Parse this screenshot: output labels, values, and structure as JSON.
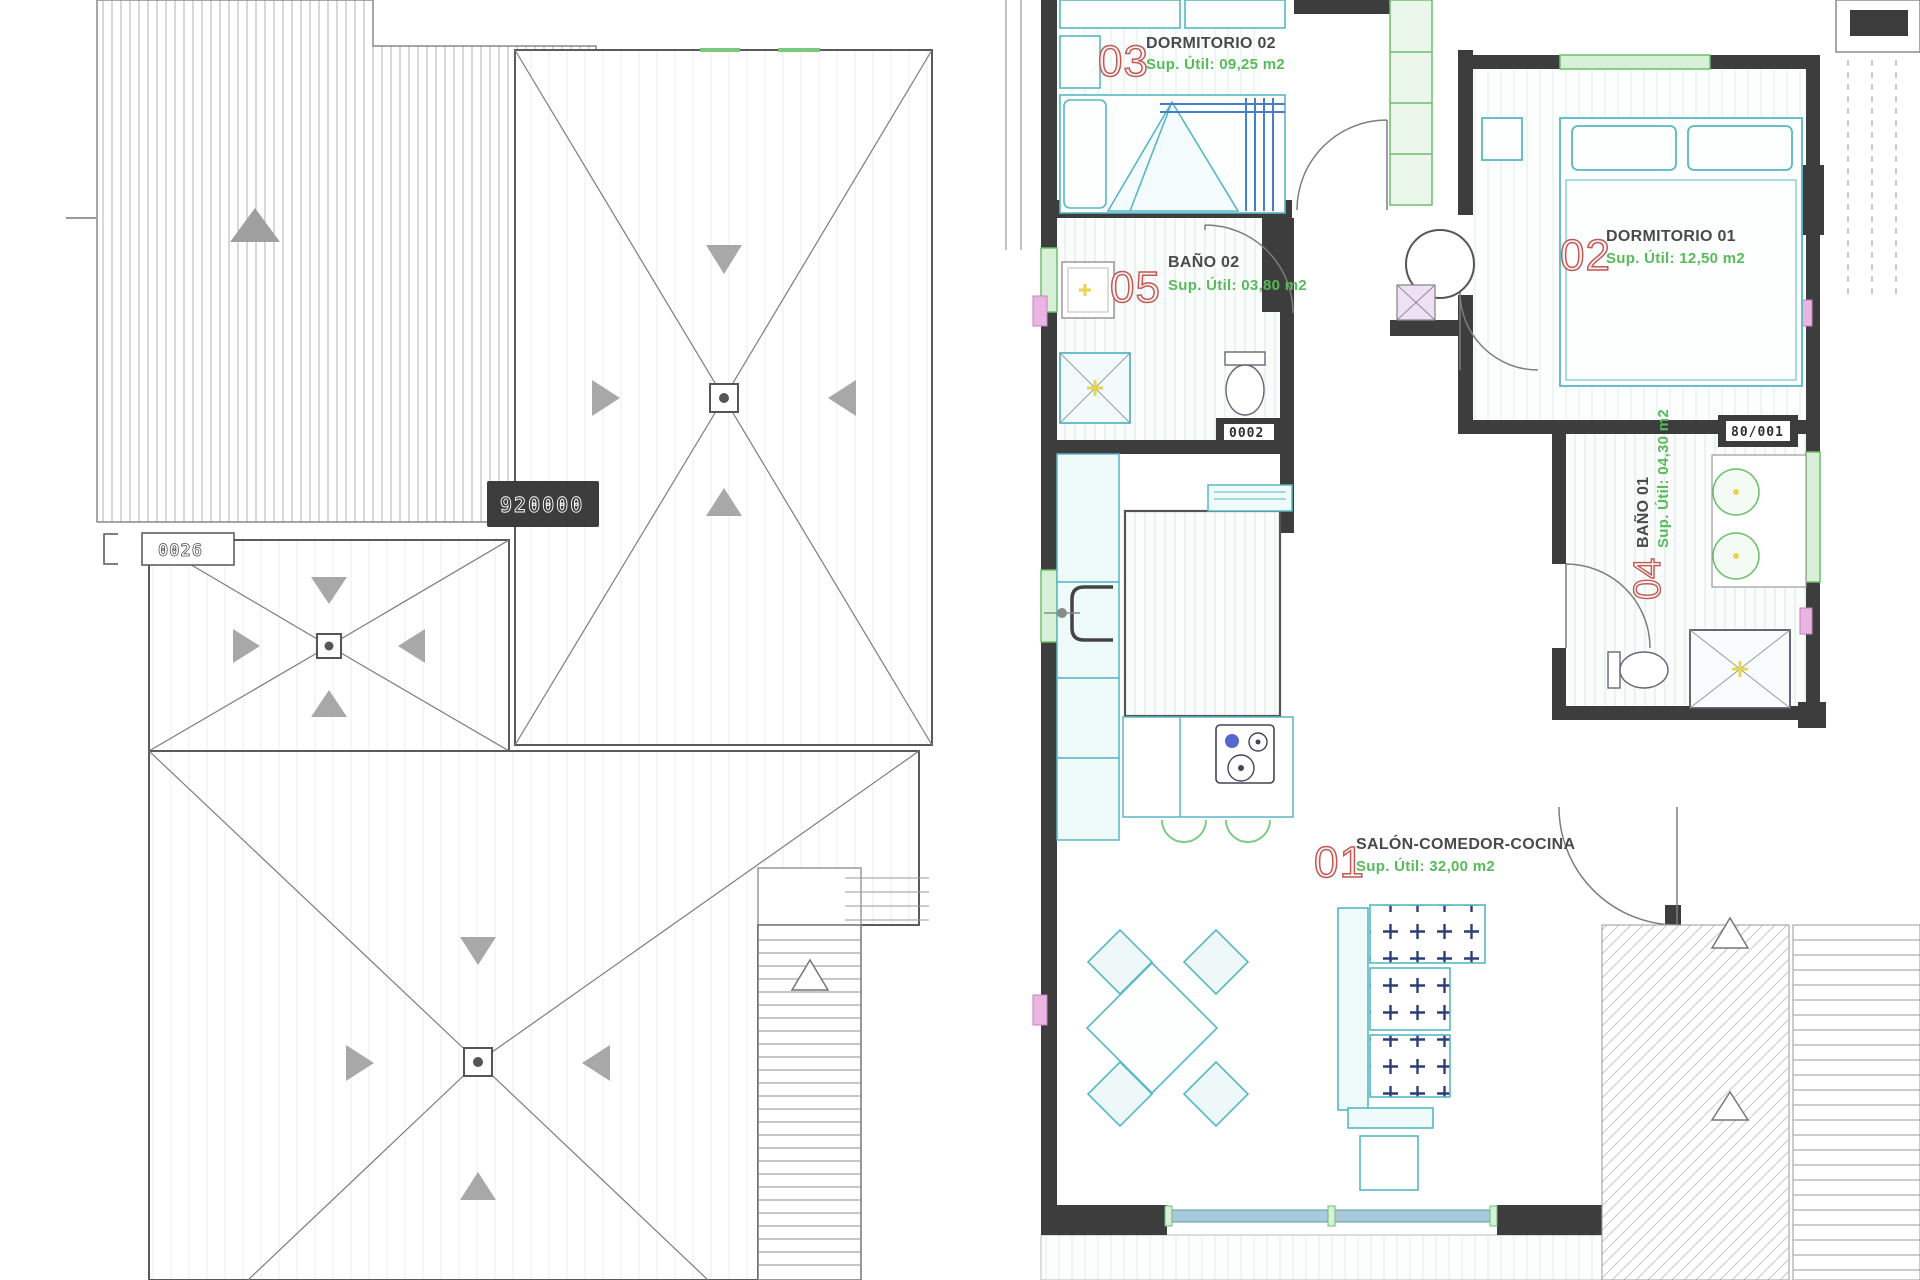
{
  "document": {
    "type": "architectural-plan-sheet",
    "left_drawing": "roof plan",
    "right_drawing": "apartment floor plan"
  },
  "roof_plan": {
    "badge_text": "920000",
    "box_text": "0026"
  },
  "floor_plan": {
    "rooms": [
      {
        "number": "01",
        "name": "SALÓN-COMEDOR-COCINA",
        "area": "Sup. Útil: 32,00 m2"
      },
      {
        "number": "02",
        "name": "DORMITORIO 01",
        "area": "Sup. Útil: 12,50 m2"
      },
      {
        "number": "03",
        "name": "DORMITORIO 02",
        "area": "Sup. Útil: 09,25 m2"
      },
      {
        "number": "04",
        "name": "BAÑO 01",
        "area": "Sup. Útil: 04,30 m2"
      },
      {
        "number": "05",
        "name": "BAÑO 02",
        "area": "Sup. Útil: 03,80 m2"
      }
    ],
    "tags": {
      "bano01": "80/001",
      "bano02": "0002"
    }
  },
  "colors": {
    "wall": "#3d3d3d",
    "furniture_cyan": "#58b7c5",
    "green": "#6cbf6c",
    "label_red": "#bf5b56",
    "label_green": "#56bb58",
    "label_dark": "#4a4a4a",
    "glass_blue": "#a9cbd9",
    "cushion_navy": "#2c3e78",
    "marker_pink": "#e9b6e4"
  }
}
